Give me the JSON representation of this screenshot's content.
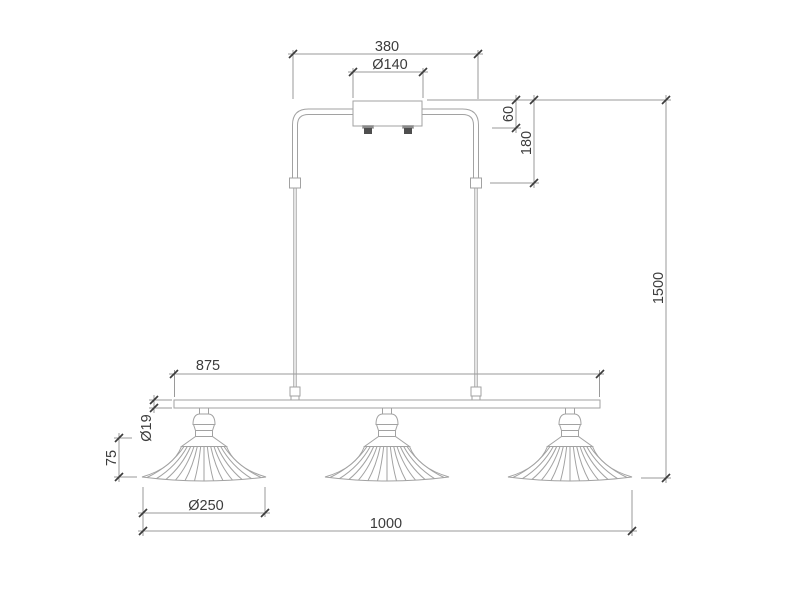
{
  "figure": {
    "kind": "technical dimension drawing",
    "subject": "three-shade pendant ceiling lamp"
  },
  "colors": {
    "background": "#ffffff",
    "object_line": "#a2a2a2",
    "dimension_line": "#9a9a9a",
    "text": "#3c3c3c",
    "connector_dark": "#4e4e4e",
    "connector_mid": "#8a8a8a"
  },
  "dimensions": {
    "canopy_span": "380",
    "canopy_diameter": "Ø140",
    "canopy_height": "60",
    "suspension_drop": "180",
    "overall_drop": "1500",
    "bar_span": "875",
    "bar_tube_diameter": "Ø19",
    "shade_height": "75",
    "shade_diameter": "Ø250",
    "overall_width": "1000"
  }
}
